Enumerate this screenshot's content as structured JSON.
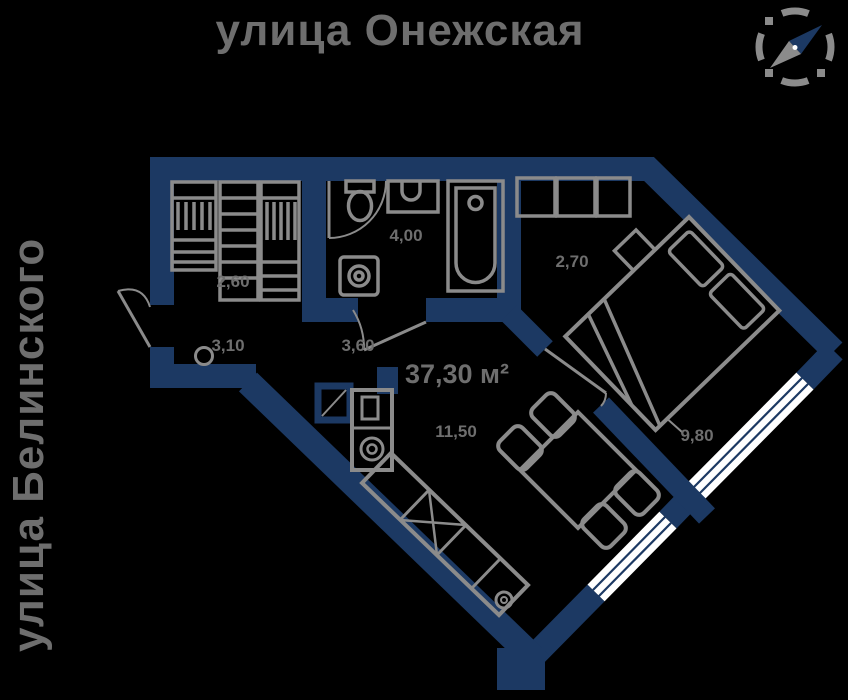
{
  "streets": {
    "top": "улица Онежская",
    "left": "улица Белинского"
  },
  "total_area_label": "37,30 м²",
  "areas": {
    "wardrobe": "2,60",
    "bathroom": "4,00",
    "hall": "2,70",
    "entry": "3,10",
    "corridor": "3,60",
    "kitchen_living": "11,50",
    "bedroom": "9,80"
  },
  "compass": {
    "icon": "compass-icon"
  },
  "colors": {
    "bg": "#000000",
    "wall": "#1c3963",
    "window": "#ffffff",
    "furniture": "#8b8b8b",
    "text": "#6e6e6e"
  }
}
